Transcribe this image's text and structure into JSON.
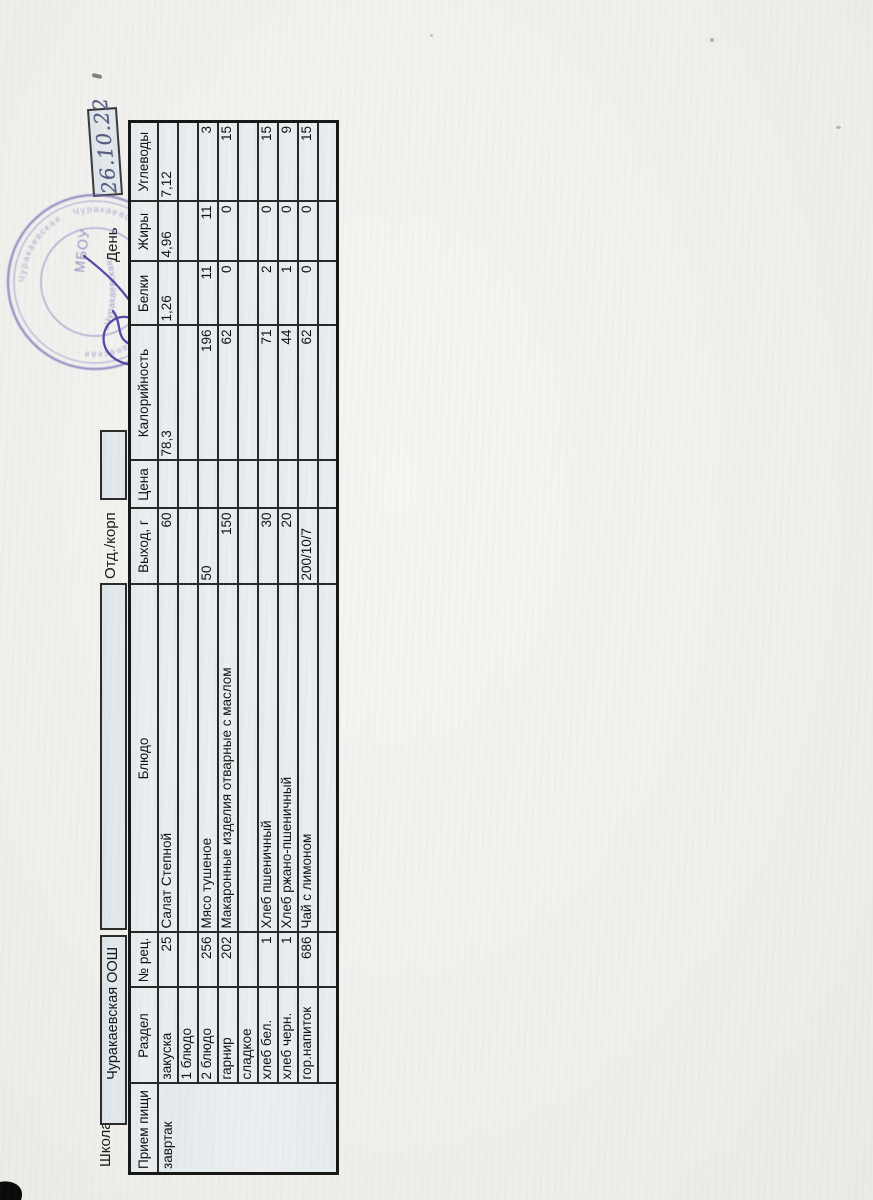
{
  "page": {
    "school_label": "Школа",
    "school_value": "Чуракаевская ООШ",
    "dept_label": "Отд./корп",
    "day_label": "День",
    "date_handwritten": "26.10.22"
  },
  "stamp": {
    "center_text": "МБОУ",
    "inner_text": "«Чуракаевская»",
    "ring_text": "Чуракаевская · Чуракаевская · Чуракаевская · Чуракаевская ·"
  },
  "table": {
    "columns": [
      "Прием пищи",
      "Раздел",
      "№ рец.",
      "Блюдо",
      "Выход, г",
      "Цена",
      "Калорийность",
      "Белки",
      "Жиры",
      "Углеводы"
    ],
    "meal_value": "завртак",
    "rows": [
      [
        "закуска",
        "25",
        "Салат Степной",
        "60",
        "",
        {
          "t": "78,3",
          "a": "l"
        },
        {
          "t": "1,26",
          "a": "l"
        },
        {
          "t": "4,96",
          "a": "l"
        },
        {
          "t": "7,12",
          "a": "l"
        }
      ],
      [
        "1 блюдо",
        "",
        "",
        "",
        "",
        "",
        "",
        "",
        ""
      ],
      [
        "2 блюдо",
        "256",
        "Мясо тушеное",
        {
          "t": "50",
          "a": "l"
        },
        "",
        "196",
        "11",
        "11",
        "3"
      ],
      [
        "гарнир",
        "202",
        "Макаронные изделия отварные с маслом",
        "150",
        "",
        "62",
        "0",
        "0",
        "15"
      ],
      [
        "сладкое",
        "",
        "",
        "",
        "",
        "",
        "",
        "",
        ""
      ],
      [
        "хлеб бел.",
        "1",
        "Хлеб пшеничный",
        "30",
        "",
        "71",
        "2",
        "0",
        "15"
      ],
      [
        "хлеб черн.",
        "1",
        "Хлеб ржано-пшеничный",
        "20",
        "",
        "44",
        "1",
        "0",
        "9"
      ],
      [
        "гор.напиток",
        "686",
        "Чай с лимоном",
        {
          "t": "200/10/7",
          "a": "l"
        },
        "",
        "62",
        "0",
        "0",
        "15"
      ],
      [
        "",
        "",
        "",
        "",
        "",
        "",
        "",
        "",
        ""
      ]
    ]
  }
}
